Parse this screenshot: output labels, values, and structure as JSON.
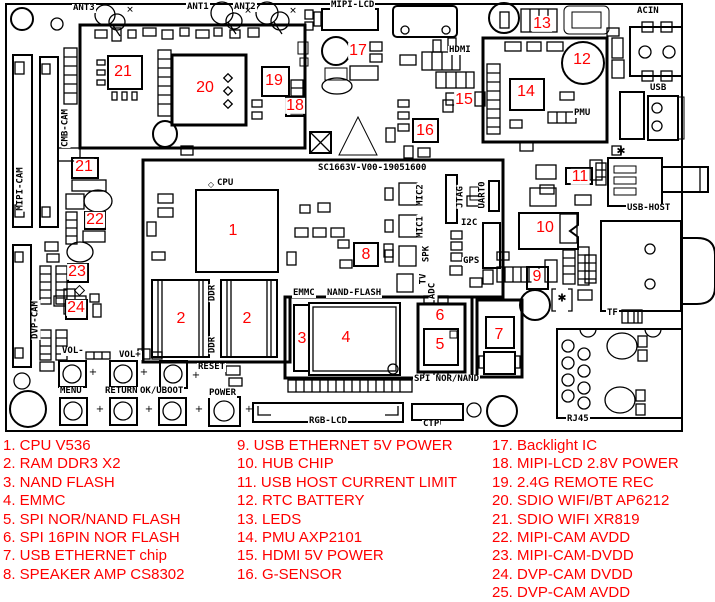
{
  "colors": {
    "annotation_red": "#ff0000",
    "line": "#000000",
    "background": "#ffffff"
  },
  "board": {
    "silkscreen_id": "SC1663V-V00-19051600",
    "labels": [
      {
        "text": "ANT3",
        "x": 72,
        "y": 4
      },
      {
        "text": "ANT1",
        "x": 186,
        "y": 3
      },
      {
        "text": "ANT2",
        "x": 233,
        "y": 3
      },
      {
        "text": "MIPI-LCD",
        "x": 330,
        "y": 1
      },
      {
        "text": "ACIN",
        "x": 636,
        "y": 7
      },
      {
        "text": "HDMI",
        "x": 448,
        "y": 46
      },
      {
        "text": "USB",
        "x": 649,
        "y": 84
      },
      {
        "text": "PMU",
        "x": 573,
        "y": 109
      },
      {
        "text": "USB-HOST",
        "x": 626,
        "y": 204
      },
      {
        "text": "CPU",
        "x": 216,
        "y": 179
      },
      {
        "text": "SC1663V-V00-19051600",
        "x": 317,
        "y": 164
      },
      {
        "text": "EMMC",
        "x": 292,
        "y": 289
      },
      {
        "text": "NAND-FLASH",
        "x": 326,
        "y": 289
      },
      {
        "text": "I2C",
        "x": 460,
        "y": 219
      },
      {
        "text": "GPS",
        "x": 462,
        "y": 257
      },
      {
        "text": "VOL-",
        "x": 61,
        "y": 347
      },
      {
        "text": "VOL+",
        "x": 118,
        "y": 351
      },
      {
        "text": "RESET",
        "x": 197,
        "y": 363
      },
      {
        "text": "MENU",
        "x": 59,
        "y": 387
      },
      {
        "text": "RETURN",
        "x": 104,
        "y": 387
      },
      {
        "text": "OK/UBOOT",
        "x": 139,
        "y": 387
      },
      {
        "text": "POWER",
        "x": 208,
        "y": 389
      },
      {
        "text": "RGB-LCD",
        "x": 308,
        "y": 417
      },
      {
        "text": "CTP",
        "x": 422,
        "y": 420
      },
      {
        "text": "SPI NOR/NAND",
        "x": 413,
        "y": 375
      },
      {
        "text": "TF",
        "x": 606,
        "y": 309
      },
      {
        "text": "RJ45",
        "x": 566,
        "y": 415
      }
    ],
    "vertical_labels": [
      {
        "text": "MIPI-CAM",
        "x": 21,
        "y": 189
      },
      {
        "text": "CMB-CAM",
        "x": 66,
        "y": 128
      },
      {
        "text": "DVP-CAM",
        "x": 36,
        "y": 320
      },
      {
        "text": "DDR",
        "x": 213,
        "y": 293
      },
      {
        "text": "DDR",
        "x": 213,
        "y": 345
      },
      {
        "text": "MIC2",
        "x": 421,
        "y": 195
      },
      {
        "text": "MIC1",
        "x": 421,
        "y": 227
      },
      {
        "text": "SPK",
        "x": 427,
        "y": 254
      },
      {
        "text": "TV",
        "x": 424,
        "y": 279
      },
      {
        "text": "ADC",
        "x": 433,
        "y": 291
      },
      {
        "text": "JTAG",
        "x": 461,
        "y": 197
      },
      {
        "text": "UART0",
        "x": 483,
        "y": 195
      }
    ],
    "markers": [
      {
        "n": "21",
        "x": 123,
        "y": 72
      },
      {
        "n": "20",
        "x": 205,
        "y": 88
      },
      {
        "n": "19",
        "x": 274,
        "y": 81
      },
      {
        "n": "18",
        "x": 295,
        "y": 106
      },
      {
        "n": "17",
        "x": 358,
        "y": 51
      },
      {
        "n": "13",
        "x": 542,
        "y": 24
      },
      {
        "n": "12",
        "x": 582,
        "y": 60
      },
      {
        "n": "14",
        "x": 526,
        "y": 92
      },
      {
        "n": "15",
        "x": 464,
        "y": 100
      },
      {
        "n": "16",
        "x": 425,
        "y": 131
      },
      {
        "n": "11",
        "x": 580,
        "y": 177
      },
      {
        "n": "10",
        "x": 545,
        "y": 228
      },
      {
        "n": "9",
        "x": 537,
        "y": 277
      },
      {
        "n": "8",
        "x": 366,
        "y": 255
      },
      {
        "n": "1",
        "x": 233,
        "y": 231
      },
      {
        "n": "2",
        "x": 181,
        "y": 319
      },
      {
        "n": "2",
        "x": 247,
        "y": 319
      },
      {
        "n": "3",
        "x": 302,
        "y": 339
      },
      {
        "n": "4",
        "x": 346,
        "y": 338
      },
      {
        "n": "6",
        "x": 440,
        "y": 316
      },
      {
        "n": "5",
        "x": 440,
        "y": 345
      },
      {
        "n": "7",
        "x": 499,
        "y": 335
      },
      {
        "n": "21",
        "x": 84,
        "y": 167
      },
      {
        "n": "22",
        "x": 95,
        "y": 220
      },
      {
        "n": "23",
        "x": 77,
        "y": 272
      },
      {
        "n": "24",
        "x": 76,
        "y": 308
      }
    ],
    "symbols": [
      {
        "g": "✱",
        "x": 621,
        "y": 151,
        "s": 11
      },
      {
        "g": "✱",
        "x": 562,
        "y": 298,
        "s": 11
      },
      {
        "g": "◇",
        "x": 211,
        "y": 185,
        "s": 8
      },
      {
        "g": "+",
        "x": 93,
        "y": 373,
        "s": 10
      },
      {
        "g": "+",
        "x": 144,
        "y": 373,
        "s": 10
      },
      {
        "g": "+",
        "x": 196,
        "y": 376,
        "s": 10
      },
      {
        "g": "+",
        "x": 100,
        "y": 410,
        "s": 10
      },
      {
        "g": "+",
        "x": 149,
        "y": 410,
        "s": 10
      },
      {
        "g": "+",
        "x": 199,
        "y": 410,
        "s": 10
      },
      {
        "g": "+",
        "x": 249,
        "y": 410,
        "s": 10
      },
      {
        "g": "✕",
        "x": 130,
        "y": 11,
        "s": 9
      },
      {
        "g": "✕",
        "x": 248,
        "y": 12,
        "s": 9
      },
      {
        "g": "✕",
        "x": 293,
        "y": 12,
        "s": 9
      }
    ]
  },
  "legend": {
    "columns": [
      {
        "x": 3,
        "items": [
          "1. CPU V536",
          "2. RAM DDR3 X2",
          "3. NAND FLASH",
          "4. EMMC",
          "5. SPI NOR/NAND FLASH",
          "6. SPI 16PIN NOR FLASH",
          "7. USB ETHERNET chip",
          "8. SPEAKER AMP CS8302"
        ]
      },
      {
        "x": 237,
        "items": [
          "9. USB ETHERNET 5V POWER",
          "10. HUB CHIP",
          "11. USB HOST CURRENT LIMIT",
          "12. RTC BATTERY",
          "13. LEDS",
          "14. PMU AXP2101",
          "15. HDMI 5V POWER",
          "16. G-SENSOR"
        ]
      },
      {
        "x": 492,
        "items": [
          "17. Backlight IC",
          "18. MIPI-LCD 2.8V POWER",
          "19. 2.4G REMOTE REC",
          "20. SDIO WIFI/BT AP6212",
          "21. SDIO WIFI XR819",
          "22. MIPI-CAM AVDD",
          "23. MIPI-CAM-DVDD",
          "24. DVP-CAM DVDD",
          "25. DVP-CAM AVDD"
        ]
      }
    ]
  }
}
